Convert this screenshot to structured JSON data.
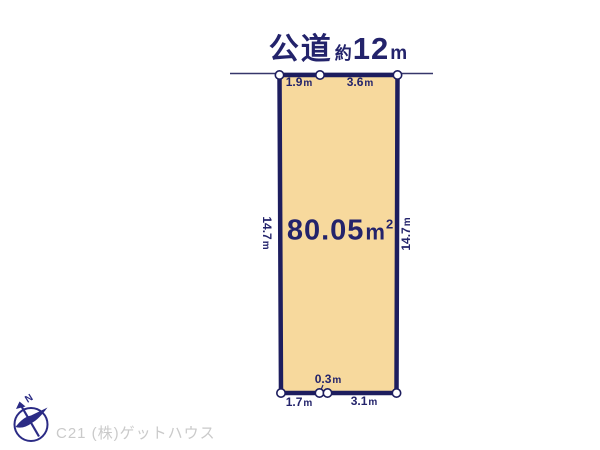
{
  "title": {
    "road": "公道",
    "approx": "約",
    "value": "12",
    "unit": "m"
  },
  "plot": {
    "area": {
      "value": "80.05",
      "unit": "m",
      "sup": "2"
    },
    "top_segments": [
      {
        "value": "1.9",
        "unit": "m"
      },
      {
        "value": "3.6",
        "unit": "m"
      }
    ],
    "left_side": {
      "value": "14.7",
      "unit": "m"
    },
    "right_side": {
      "value": "14.7",
      "unit": "m"
    },
    "bottom_segments": [
      {
        "value": "1.7",
        "unit": "m"
      },
      {
        "value": "0.3",
        "unit": "m"
      },
      {
        "value": "3.1",
        "unit": "m"
      }
    ]
  },
  "footer": {
    "company": "C21 (株)ゲットハウス",
    "north": "N"
  },
  "colors": {
    "text_navy": "#23236B",
    "plot_border": "#1D1D5E",
    "plot_fill": "#F7D99D",
    "road_line": "#36366A",
    "marker_fill": "#FFFFFF",
    "compass_navy": "#2B2B85",
    "watermark_gray": "#CACACA",
    "background": "#FFFFFF"
  }
}
